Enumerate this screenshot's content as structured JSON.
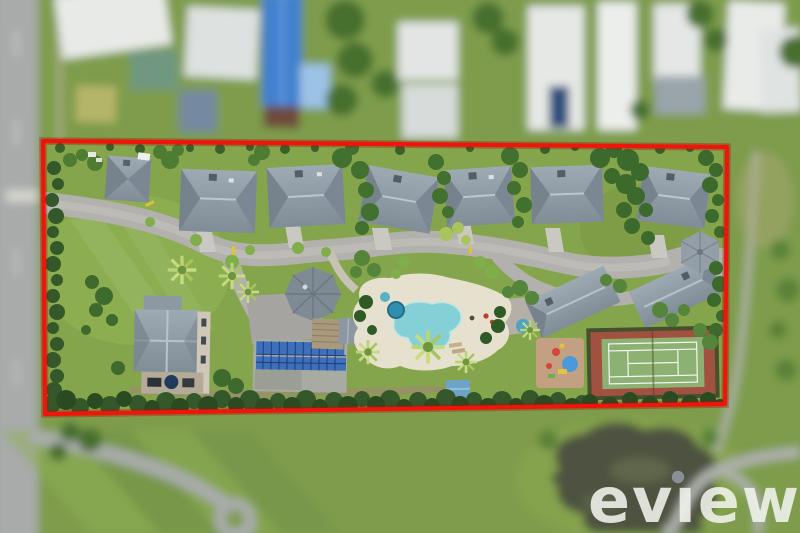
{
  "scene": {
    "image_type": "aerial drone photograph of a resort-style residential property",
    "watermark": {
      "text": "eview",
      "display_text": "evıew",
      "color": "#f2f4ee",
      "i_dot_color": "#8b929b"
    },
    "boundary": {
      "color": "#ee150b",
      "glow_color": "#a80f06",
      "description": "red property outline"
    },
    "palette": {
      "grass_outside": "#7e9c4b",
      "grass_inside": "#84a54c",
      "lawn_light": "#8fb053",
      "street": "#a8abaa",
      "driveway": "#b2b1ad",
      "driveway_wear": "#c8c7c2",
      "roof_light": "#9aa5ae",
      "roof_mid": "#848f99",
      "roof_dark": "#76828c",
      "pool_water": "#84d0d6",
      "pool_deck": "#e6e0cf",
      "spa_water": "#2f8fae",
      "tennis_surround": "#a05140",
      "tennis_court": "#8db173",
      "tennis_line": "#ffffff",
      "solar_panel": "#3e6fba",
      "tree_dark": "#3a602a",
      "tree_mid": "#4f7c33",
      "tree_light": "#79a846",
      "palm_frond": "#c7dc7e",
      "pond": "#4d5340",
      "barn_blue": "#3f80cf"
    },
    "features": [
      "neighbourhood street",
      "neighbouring houses",
      "red property boundary",
      "internal driveway loop",
      "grey-roofed residential units",
      "gazebo",
      "community building",
      "main residence",
      "solar panel roof",
      "swimming pool",
      "round spa",
      "palm trees",
      "playground",
      "tennis court",
      "garden hedges",
      "pond",
      "eview watermark"
    ]
  }
}
